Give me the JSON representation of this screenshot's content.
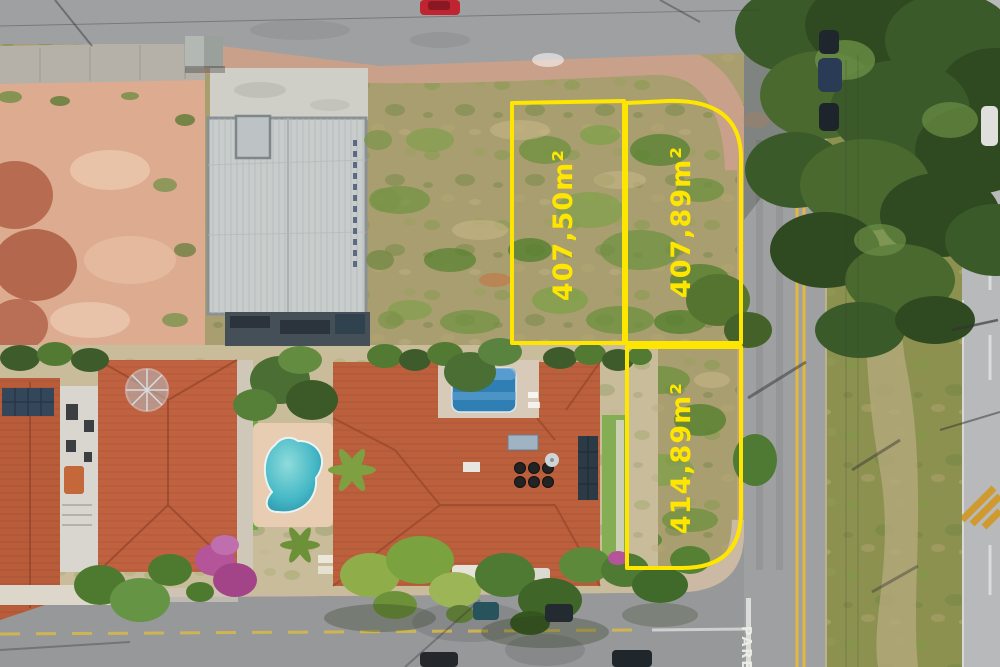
{
  "image": {
    "title": "Aerial drone view of vacant corner land plots for sale beside residential houses",
    "width": 1000,
    "height": 667
  },
  "plots": [
    {
      "name": "plot-1",
      "area_label": "407,50m²"
    },
    {
      "name": "plot-2",
      "area_label": "407,89m²"
    },
    {
      "name": "plot-3",
      "area_label": "414,89m²"
    }
  ],
  "road_markings": {
    "stop_word": "PARE"
  },
  "colors": {
    "plot_outline": "#ffe600",
    "plot_label": "#ffe600",
    "stop_text": "#f0f0ea",
    "road_asphalt": "#9fa0a2",
    "bottom_road": "#97989a",
    "far_road": "#b7b9ba",
    "grass_field": "#a89e6f",
    "median_grass": "#8d9150",
    "dirt_lot": "#dcab90",
    "terracotta_roof": "#bc5f3d",
    "warehouse_roof": "#c8cccb",
    "pool_water": "#3fb2c0",
    "tree_canopy": "#3f5d2c",
    "double_yellow_line": "#e3b93c"
  }
}
